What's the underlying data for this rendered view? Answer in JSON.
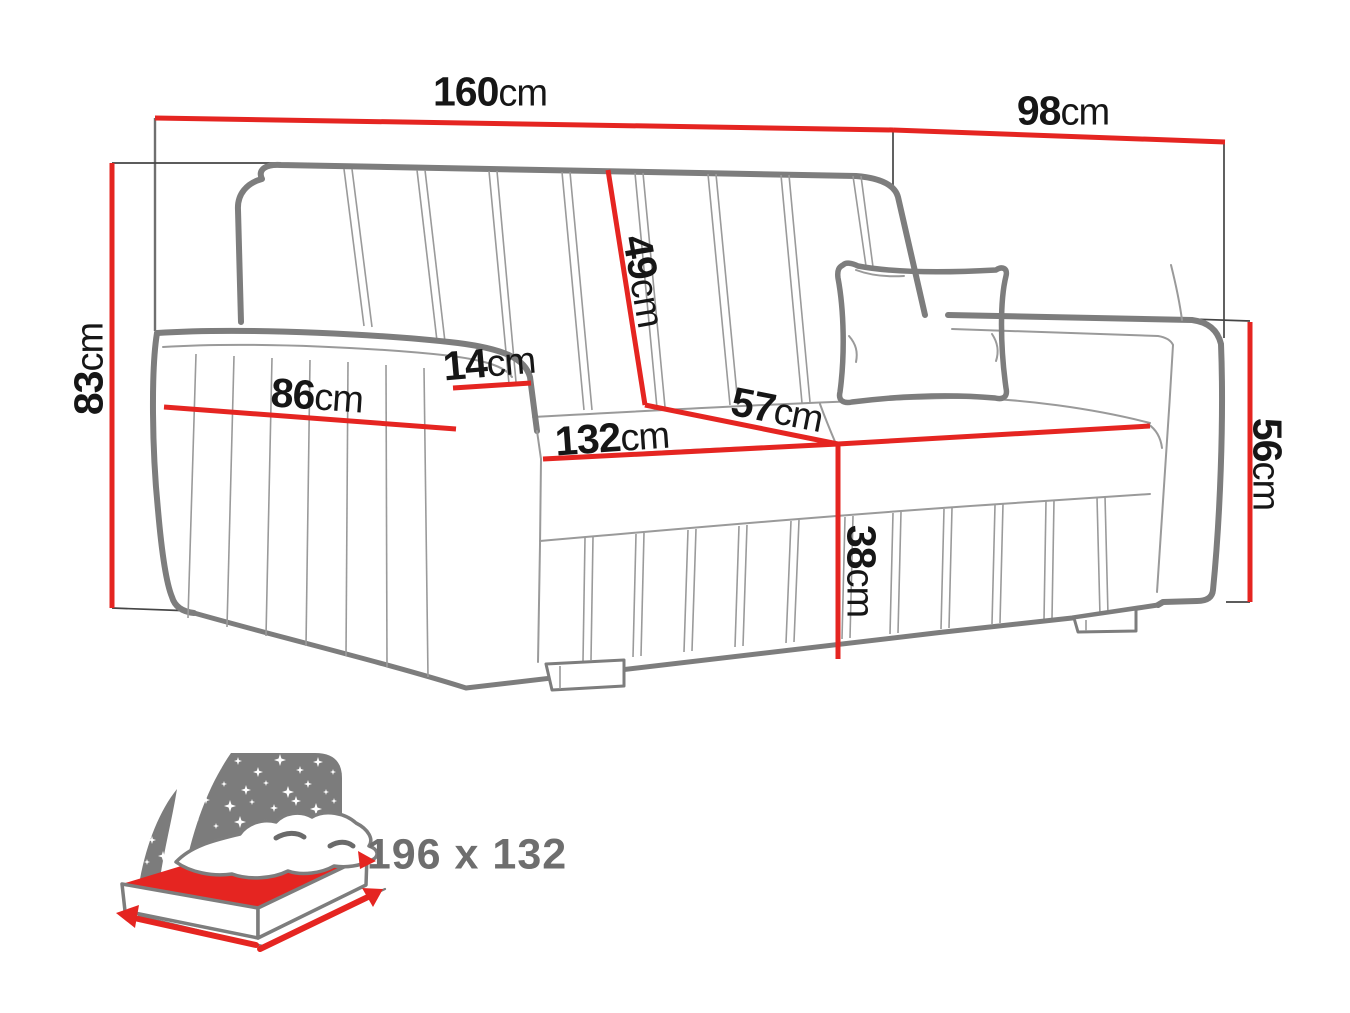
{
  "diagram_title": "sofa-bed-dimensions-diagram",
  "dimensions": {
    "total_width": {
      "value": "160",
      "unit": "cm"
    },
    "total_depth": {
      "value": "98",
      "unit": "cm"
    },
    "total_height": {
      "value": "83",
      "unit": "cm"
    },
    "backrest_height": {
      "value": "49",
      "unit": "cm"
    },
    "armrest_width": {
      "value": "14",
      "unit": "cm"
    },
    "armrest_depth": {
      "value": "86",
      "unit": "cm"
    },
    "seat_width": {
      "value": "132",
      "unit": "cm"
    },
    "seat_depth": {
      "value": "57",
      "unit": "cm"
    },
    "armrest_height_right": {
      "value": "56",
      "unit": "cm"
    },
    "seat_height": {
      "value": "38",
      "unit": "cm"
    }
  },
  "bed_function": {
    "icon": "sofa-bed-sleeping-area-icon",
    "sleeping_area": "196 x 132"
  },
  "colors": {
    "dimension_red": "#e52521",
    "outline_gray": "#7d7d7d",
    "seam_gray": "#9a9a9a",
    "witness_dark": "#454545",
    "label_black": "#161616",
    "bed_icon_gray": "#7c7c7c",
    "bed_text_gray": "#6e6e6e"
  }
}
